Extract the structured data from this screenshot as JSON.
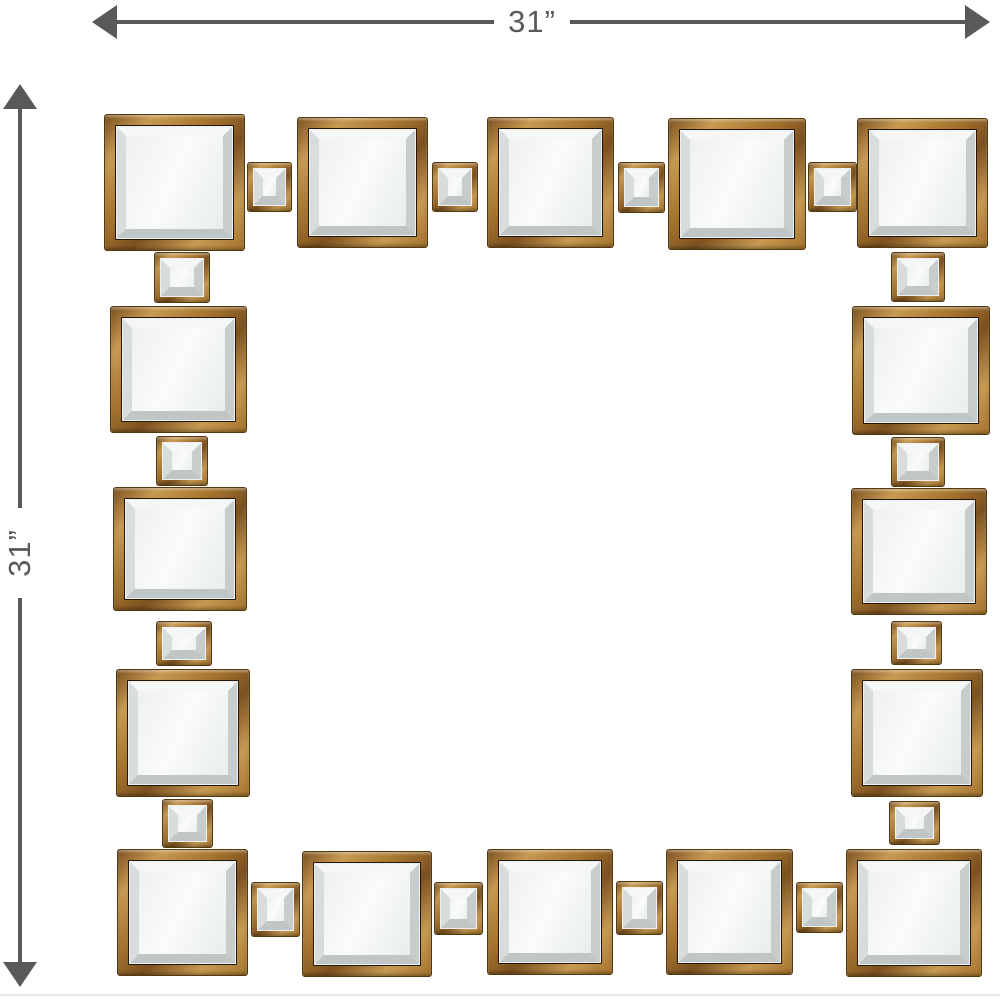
{
  "annotations": {
    "width_label": "31”",
    "height_label": "31”",
    "line_color": "#58595b"
  },
  "mirror": {
    "colors": {
      "gold_light": "#c79a52",
      "gold_mid": "#a5742e",
      "gold_dark": "#7c5120",
      "frame_line": "#241708",
      "bevel_light": "#f5f7f7",
      "bevel_shade": "#c7cccc",
      "mirror_face": "#fafbfb"
    },
    "large_squares": [
      {
        "x": 104,
        "y": 114,
        "w": 141,
        "h": 137
      },
      {
        "x": 297,
        "y": 117,
        "w": 131,
        "h": 131
      },
      {
        "x": 487,
        "y": 117,
        "w": 127,
        "h": 131
      },
      {
        "x": 668,
        "y": 118,
        "w": 138,
        "h": 132
      },
      {
        "x": 857,
        "y": 118,
        "w": 131,
        "h": 130
      },
      {
        "x": 110,
        "y": 306,
        "w": 137,
        "h": 127
      },
      {
        "x": 113,
        "y": 487,
        "w": 134,
        "h": 124
      },
      {
        "x": 116,
        "y": 669,
        "w": 134,
        "h": 128
      },
      {
        "x": 117,
        "y": 849,
        "w": 131,
        "h": 127
      },
      {
        "x": 852,
        "y": 306,
        "w": 138,
        "h": 129
      },
      {
        "x": 851,
        "y": 488,
        "w": 136,
        "h": 127
      },
      {
        "x": 851,
        "y": 669,
        "w": 132,
        "h": 128
      },
      {
        "x": 846,
        "y": 849,
        "w": 136,
        "h": 128
      },
      {
        "x": 302,
        "y": 851,
        "w": 130,
        "h": 126
      },
      {
        "x": 487,
        "y": 849,
        "w": 126,
        "h": 126
      },
      {
        "x": 666,
        "y": 849,
        "w": 127,
        "h": 126
      }
    ],
    "small_squares": [
      {
        "x": 247,
        "y": 162,
        "w": 45,
        "h": 50
      },
      {
        "x": 432,
        "y": 162,
        "w": 46,
        "h": 50
      },
      {
        "x": 618,
        "y": 162,
        "w": 47,
        "h": 51
      },
      {
        "x": 808,
        "y": 162,
        "w": 49,
        "h": 50
      },
      {
        "x": 154,
        "y": 252,
        "w": 56,
        "h": 51
      },
      {
        "x": 156,
        "y": 436,
        "w": 52,
        "h": 50
      },
      {
        "x": 156,
        "y": 621,
        "w": 56,
        "h": 45
      },
      {
        "x": 162,
        "y": 799,
        "w": 51,
        "h": 49
      },
      {
        "x": 891,
        "y": 252,
        "w": 54,
        "h": 50
      },
      {
        "x": 891,
        "y": 437,
        "w": 54,
        "h": 50
      },
      {
        "x": 891,
        "y": 621,
        "w": 51,
        "h": 44
      },
      {
        "x": 889,
        "y": 801,
        "w": 51,
        "h": 44
      },
      {
        "x": 251,
        "y": 882,
        "w": 49,
        "h": 55
      },
      {
        "x": 434,
        "y": 882,
        "w": 49,
        "h": 53
      },
      {
        "x": 616,
        "y": 881,
        "w": 47,
        "h": 54
      },
      {
        "x": 796,
        "y": 882,
        "w": 47,
        "h": 51
      }
    ]
  }
}
